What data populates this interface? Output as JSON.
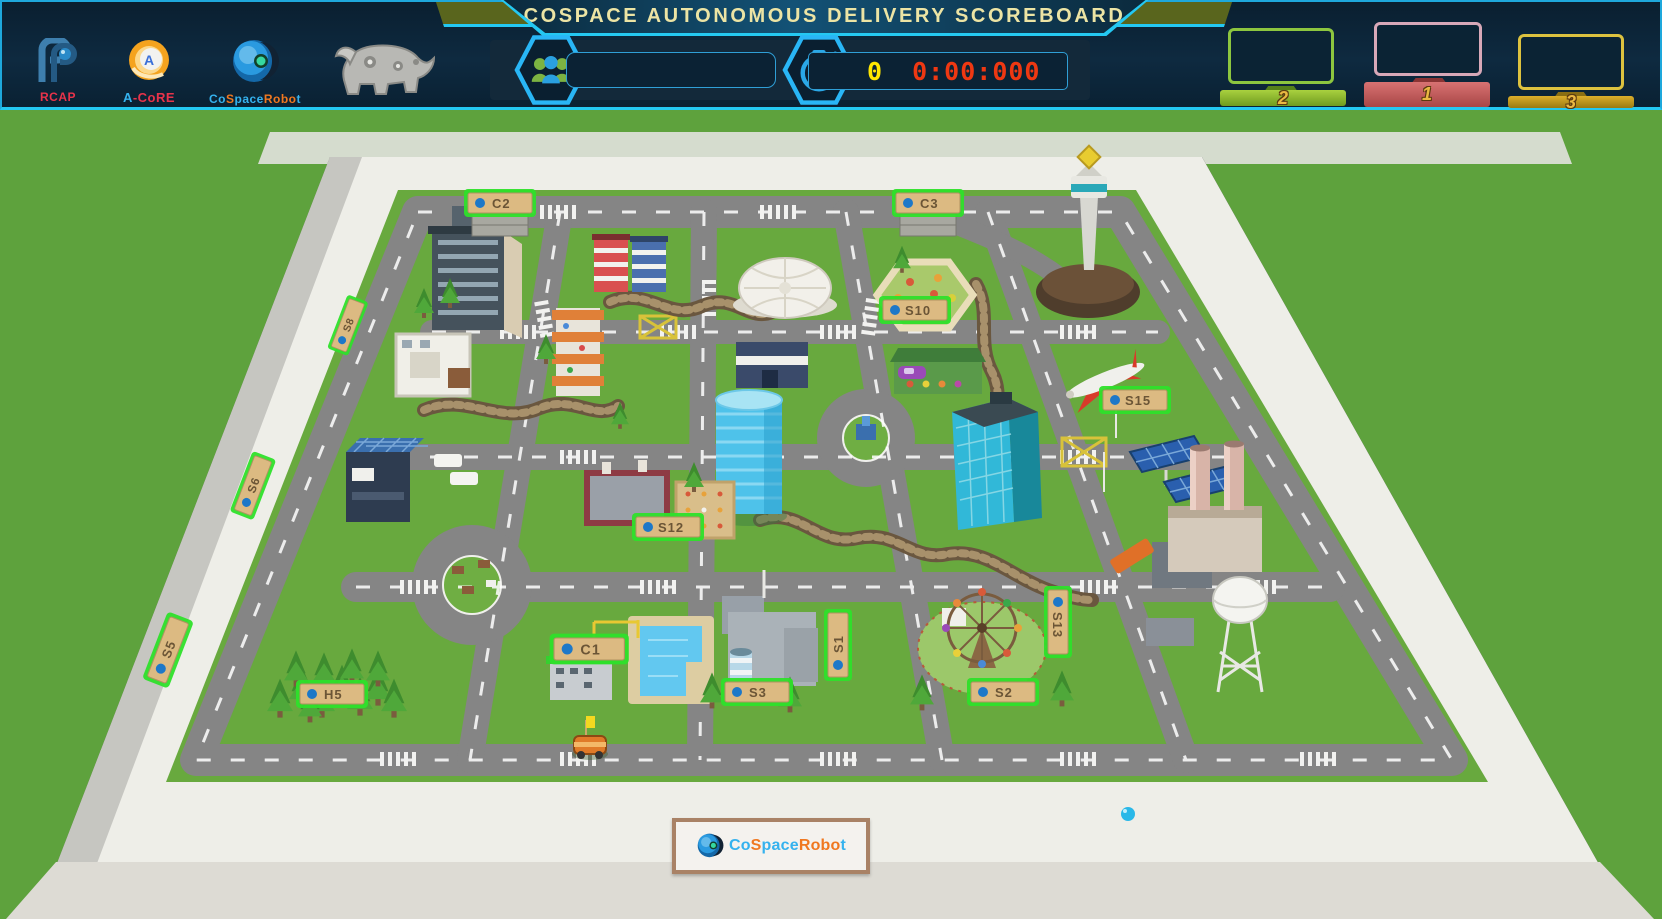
{
  "header": {
    "title": "COSPACE AUTONOMOUS DELIVERY SCOREBOARD",
    "logos": {
      "rcap": "RCAP",
      "acore_a": "A",
      "acore_rest": "-CoRE",
      "brand_p1": "Co",
      "brand_p2": "S",
      "brand_p3": "pace",
      "brand_p4": "Robo",
      "brand_p5": "t"
    },
    "team": {
      "value": ""
    },
    "score": {
      "points": "0",
      "time": "0:00:000"
    },
    "podiums": [
      {
        "rank": "2"
      },
      {
        "rank": "1"
      },
      {
        "rank": "3"
      }
    ]
  },
  "map": {
    "markers": {
      "c1": "C1",
      "c2": "C2",
      "c3": "C3",
      "s1": "S1",
      "s2": "S2",
      "s3": "S3",
      "s5": "S5",
      "s6": "S6",
      "s8": "S8",
      "s10": "S10",
      "s12": "S12",
      "s13": "S13",
      "s15": "S15",
      "h5": "H5"
    }
  },
  "colors": {
    "accent_cyan": "#24c8f2",
    "header_navy": "#0c2436",
    "grass": "#5ea23d",
    "score_yellow": "#ffe600",
    "timer_red": "#ef3812",
    "podium_green": "#8dc63f",
    "podium_red": "#c35b5b",
    "podium_gold": "#d4a21e",
    "marker_glow": "#2ee02a"
  }
}
